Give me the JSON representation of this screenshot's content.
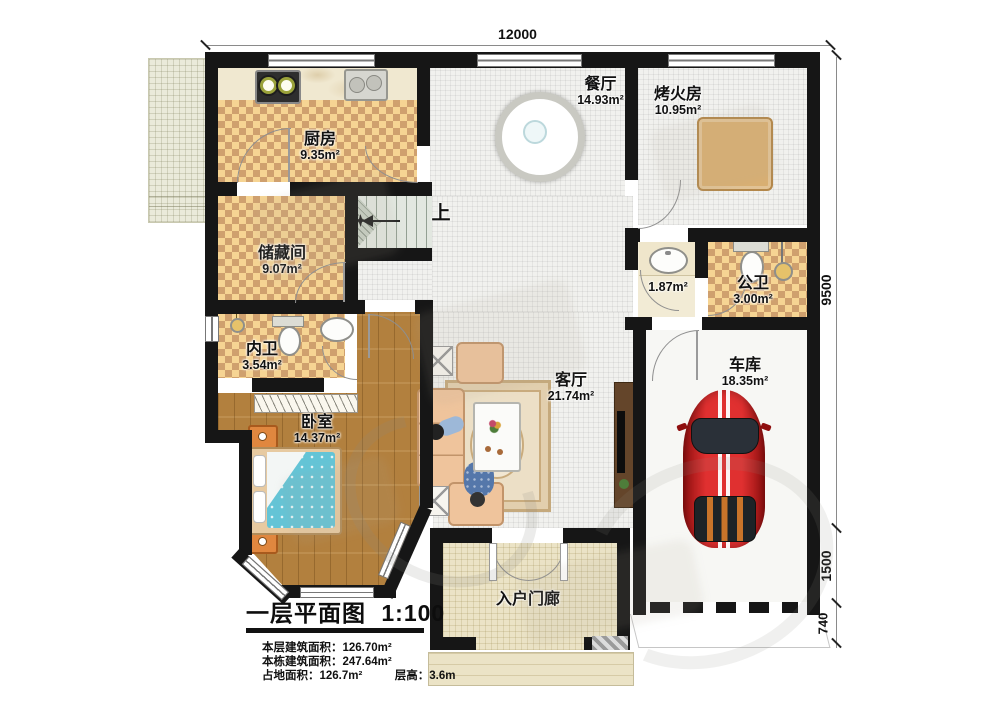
{
  "dimensions": {
    "top": "12000",
    "right_top": "9500",
    "right_mid": "1500",
    "right_bottom": "740"
  },
  "rooms": {
    "kitchen": {
      "name": "厨房",
      "area": "9.35m²"
    },
    "dining": {
      "name": "餐厅",
      "area": "14.93m²"
    },
    "fire_room": {
      "name": "烤火房",
      "area": "10.95m²"
    },
    "storage": {
      "name": "储藏间",
      "area": "9.07m²"
    },
    "wash": {
      "area": "1.87m²"
    },
    "public_wc": {
      "name": "公卫",
      "area": "3.00m²"
    },
    "private_wc": {
      "name": "内卫",
      "area": "3.54m²"
    },
    "bedroom": {
      "name": "卧室",
      "area": "14.37m²"
    },
    "living": {
      "name": "客厅",
      "area": "21.74m²"
    },
    "garage": {
      "name": "车库",
      "area": "18.35m²"
    },
    "porch": {
      "name": "入户门廊"
    }
  },
  "stairs": {
    "direction_label": "上"
  },
  "title_block": {
    "title": "一层平面图",
    "scale": "1:100",
    "stats": [
      {
        "label": "本层建筑面积：",
        "value": "126.70m²"
      },
      {
        "label": "本栋建筑面积：",
        "value": "247.64m²"
      },
      {
        "label": "占地面积：",
        "value": "126.7m²"
      },
      {
        "label": "层高：",
        "value": "3.6m"
      }
    ]
  },
  "colors": {
    "wall": "#161616",
    "checker_light": "#f6d493",
    "checker_dark": "#cfa06e",
    "wood": "#b2803e",
    "bed": "#64c4d6",
    "car": "#d42222"
  }
}
